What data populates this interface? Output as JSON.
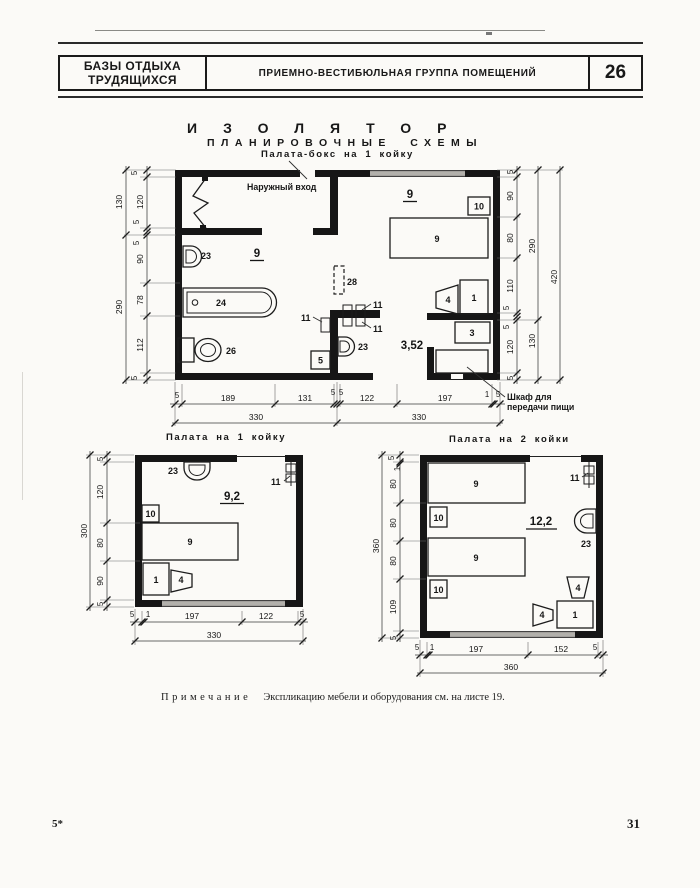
{
  "header": {
    "org_line1": "БАЗЫ ОТДЫХА",
    "org_line2": "ТРУДЯЩИХСЯ",
    "section_title": "ПРИЕМНО-ВЕСТИБЮЛЬНАЯ ГРУППА ПОМЕЩЕНИЙ",
    "sheet_number": "26"
  },
  "titles": {
    "main": "ИЗОЛЯТОР",
    "subtitle": "ПЛАНИРОВОЧНЫЕ СХЕМЫ"
  },
  "note": {
    "label": "Примечание",
    "text": "Экспликацию мебели и оборудования см. на листе 19."
  },
  "footer": {
    "left": "5*",
    "right": "31"
  },
  "colors": {
    "ink": "#161616",
    "window_gray": "#b2b0ab",
    "paper": "#fbfaf7"
  },
  "plan_box": {
    "title": "Палата-бокс на 1 койку",
    "entrance_label": "Наружный вход",
    "cupboard_line1": "Шкаф для",
    "cupboard_line2": "передачи пищи",
    "corridor_area": "3,52",
    "room_left_label": "9",
    "room_right_label": "9",
    "items": {
      "sink_bath": "23",
      "bath": "24",
      "wc": "26",
      "screen": "28",
      "hook_left": "11",
      "hook_top": "11",
      "hook_bottom": "11",
      "sink_corridor": "23",
      "stool": "5",
      "bed": "9",
      "nightstand": "10",
      "chair": "4",
      "table": "1",
      "stand": "3"
    },
    "dims": {
      "left_inner": [
        "5",
        "120",
        "5",
        "5",
        "90",
        "78",
        "112",
        "5"
      ],
      "left_outer": [
        "130",
        "290"
      ],
      "right_inner": [
        "5",
        "90",
        "80",
        "110",
        "5",
        "5",
        "120",
        "5"
      ],
      "right_mid": [
        "290",
        "130"
      ],
      "right_outer": "420",
      "bottom_inner": [
        "5",
        "189",
        "131",
        "5",
        "5",
        "122",
        "197",
        "1",
        "5"
      ],
      "bottom_outer": [
        "330",
        "330"
      ]
    }
  },
  "plan_one": {
    "title": "Палата на 1 койку",
    "room_area": "9,2",
    "items": {
      "sink": "23",
      "hook": "11",
      "nightstand": "10",
      "bed": "9",
      "table": "1",
      "chair": "4"
    },
    "dims": {
      "left_inner": [
        "5",
        "120",
        "80",
        "90",
        "5"
      ],
      "left_outer": "300",
      "bottom_inner": [
        "5",
        "1",
        "197",
        "122",
        "5"
      ],
      "bottom_outer": "330"
    }
  },
  "plan_two": {
    "title": "Палата на 2 койки",
    "room_area": "12,2",
    "items": {
      "bed1": "9",
      "bed2": "9",
      "nightstand1": "10",
      "nightstand2": "10",
      "hook": "11",
      "sink": "23",
      "chair_top": "4",
      "chair_left": "4",
      "table": "1"
    },
    "dims": {
      "left_inner": [
        "5",
        "1",
        "80",
        "80",
        "80",
        "109",
        "5"
      ],
      "left_outer": "360",
      "bottom_inner": [
        "5",
        "1",
        "197",
        "152",
        "5"
      ],
      "bottom_outer": "360"
    }
  }
}
